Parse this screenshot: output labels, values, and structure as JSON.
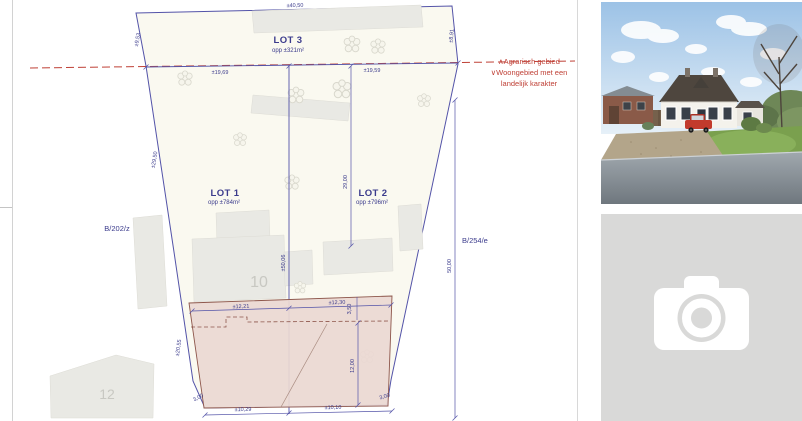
{
  "plan": {
    "lots": {
      "lot3": {
        "name": "LOT 3",
        "area": "opp ±321m²"
      },
      "lot1": {
        "name": "LOT 1",
        "area": "opp ±784m²"
      },
      "lot2": {
        "name": "LOT 2",
        "area": "opp ±796m²"
      }
    },
    "parcels": {
      "left": "B/202/z",
      "right": "B/254/e"
    },
    "zoning": {
      "line1": "∧Agrarisch gebied",
      "line2": "∨Woongebied met een",
      "line3": "landelijk karakter"
    },
    "house_numbers": {
      "main": "10",
      "neighbor": "12"
    },
    "dims": {
      "top": "±40,50",
      "split_left": "±19,69",
      "split_right": "±19,59",
      "edge_top_left": "±9,53",
      "edge_top_right": "±8,91",
      "edge_left_upper": "±29,50",
      "edge_left_lower": "±20,55",
      "lot2_depth": "29,00",
      "divider_length": "±50,06",
      "right_depth": "50,00",
      "zone_front_left": "±12,21",
      "zone_front_right": "±12,30",
      "zone_strip_depth": "3,50",
      "zone_depth": "12,00",
      "zone_rear_left": "±10,29",
      "zone_rear_right": "±10,10",
      "offset_left": "3,00",
      "offset_right": "3,00"
    },
    "colors": {
      "line": "#5353a8",
      "text": "#3b3b8c",
      "red": "#bf4036",
      "zone_fill": "#ead8d3",
      "zone_stroke": "#8d564b"
    }
  },
  "gallery": {
    "photo_top": "house-photo",
    "placeholder_icon": "camera-icon"
  }
}
